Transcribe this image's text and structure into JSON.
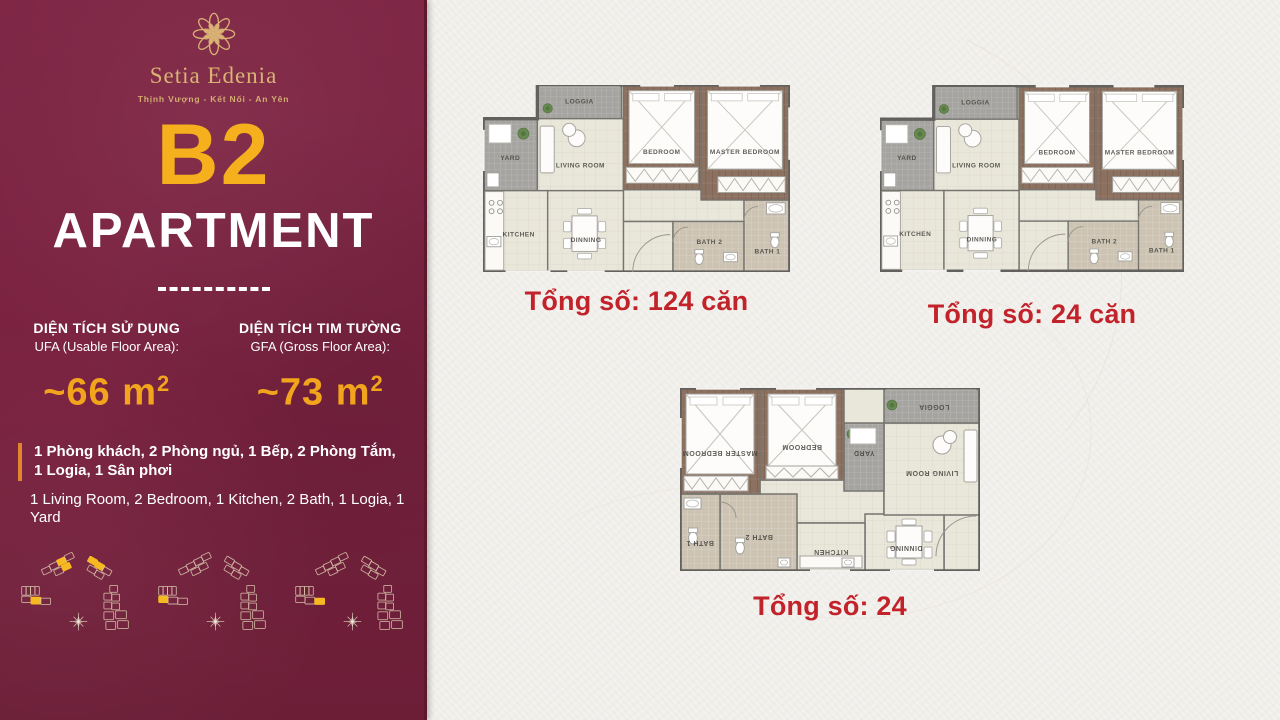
{
  "colors": {
    "sidebar_maroon": "#7a2240",
    "accent_gold": "#f6b01e",
    "value_gold": "#f2a41c",
    "caption_red": "#c2232b",
    "highlight_yellow": "#f7b922",
    "feature_bar_orange": "#e0862c"
  },
  "sidebar": {
    "logo": {
      "brand": "Setia Edenia",
      "tagline": "Thịnh Vượng - Kết Nối - An Yên"
    },
    "unit_code": "B2",
    "unit_type": "APARTMENT",
    "areas": [
      {
        "title": "DIỆN TÍCH SỬ DỤNG",
        "subtitle": "UFA (Usable Floor Area):",
        "value": "~66 m",
        "sup": "2"
      },
      {
        "title": "DIỆN TÍCH TIM TƯỜNG",
        "subtitle": "GFA (Gross Floor Area):",
        "value": "~73 m",
        "sup": "2"
      }
    ],
    "features_vi": "1 Phòng khách, 2 Phòng ngủ, 1 Bếp, 2 Phòng Tắm, 1 Logia, 1 Sân phơi",
    "features_en": "1 Living Room, 2 Bedroom, 1 Kitchen, 2 Bath, 1 Logia, 1 Yard"
  },
  "site_diagrams": [
    {
      "highlights": [
        "L5",
        "M2",
        "M5",
        "T0",
        "T1"
      ]
    },
    {
      "highlights": [
        "L4"
      ]
    },
    {
      "highlights": [
        "L6"
      ]
    }
  ],
  "main": {
    "floor_plans": [
      {
        "variant": "A",
        "caption": "Tổng số: 124 căn",
        "rooms": {
          "loggia": "LOGGIA",
          "yard": "YARD",
          "living": "LIVING ROOM",
          "bedroom": "BEDROOM",
          "master": "MASTER BEDROOM",
          "kitchen": "KITCHEN",
          "dinning": "DINNING",
          "bath2": "BATH 2",
          "bath1": "BATH 1"
        }
      },
      {
        "variant": "A",
        "caption": "Tổng số: 24 căn",
        "rooms": {
          "loggia": "LOGGIA",
          "yard": "YARD",
          "living": "LIVING ROOM",
          "bedroom": "BEDROOM",
          "master": "MASTER BEDROOM",
          "kitchen": "KITCHEN",
          "dinning": "DINNING",
          "bath2": "BATH 2",
          "bath1": "BATH 1"
        }
      },
      {
        "variant": "B",
        "caption": "Tổng số: 24",
        "rooms": {
          "loggia": "LOGGIA",
          "yard": "YARD",
          "living": "LIVING ROOM",
          "bedroom": "BEDROOM",
          "master": "MASTER BEDROOM",
          "kitchen": "KITCHEN",
          "dinning": "DINNING",
          "bath2": "BATH 2",
          "bath1": "BATH 1"
        }
      }
    ]
  }
}
